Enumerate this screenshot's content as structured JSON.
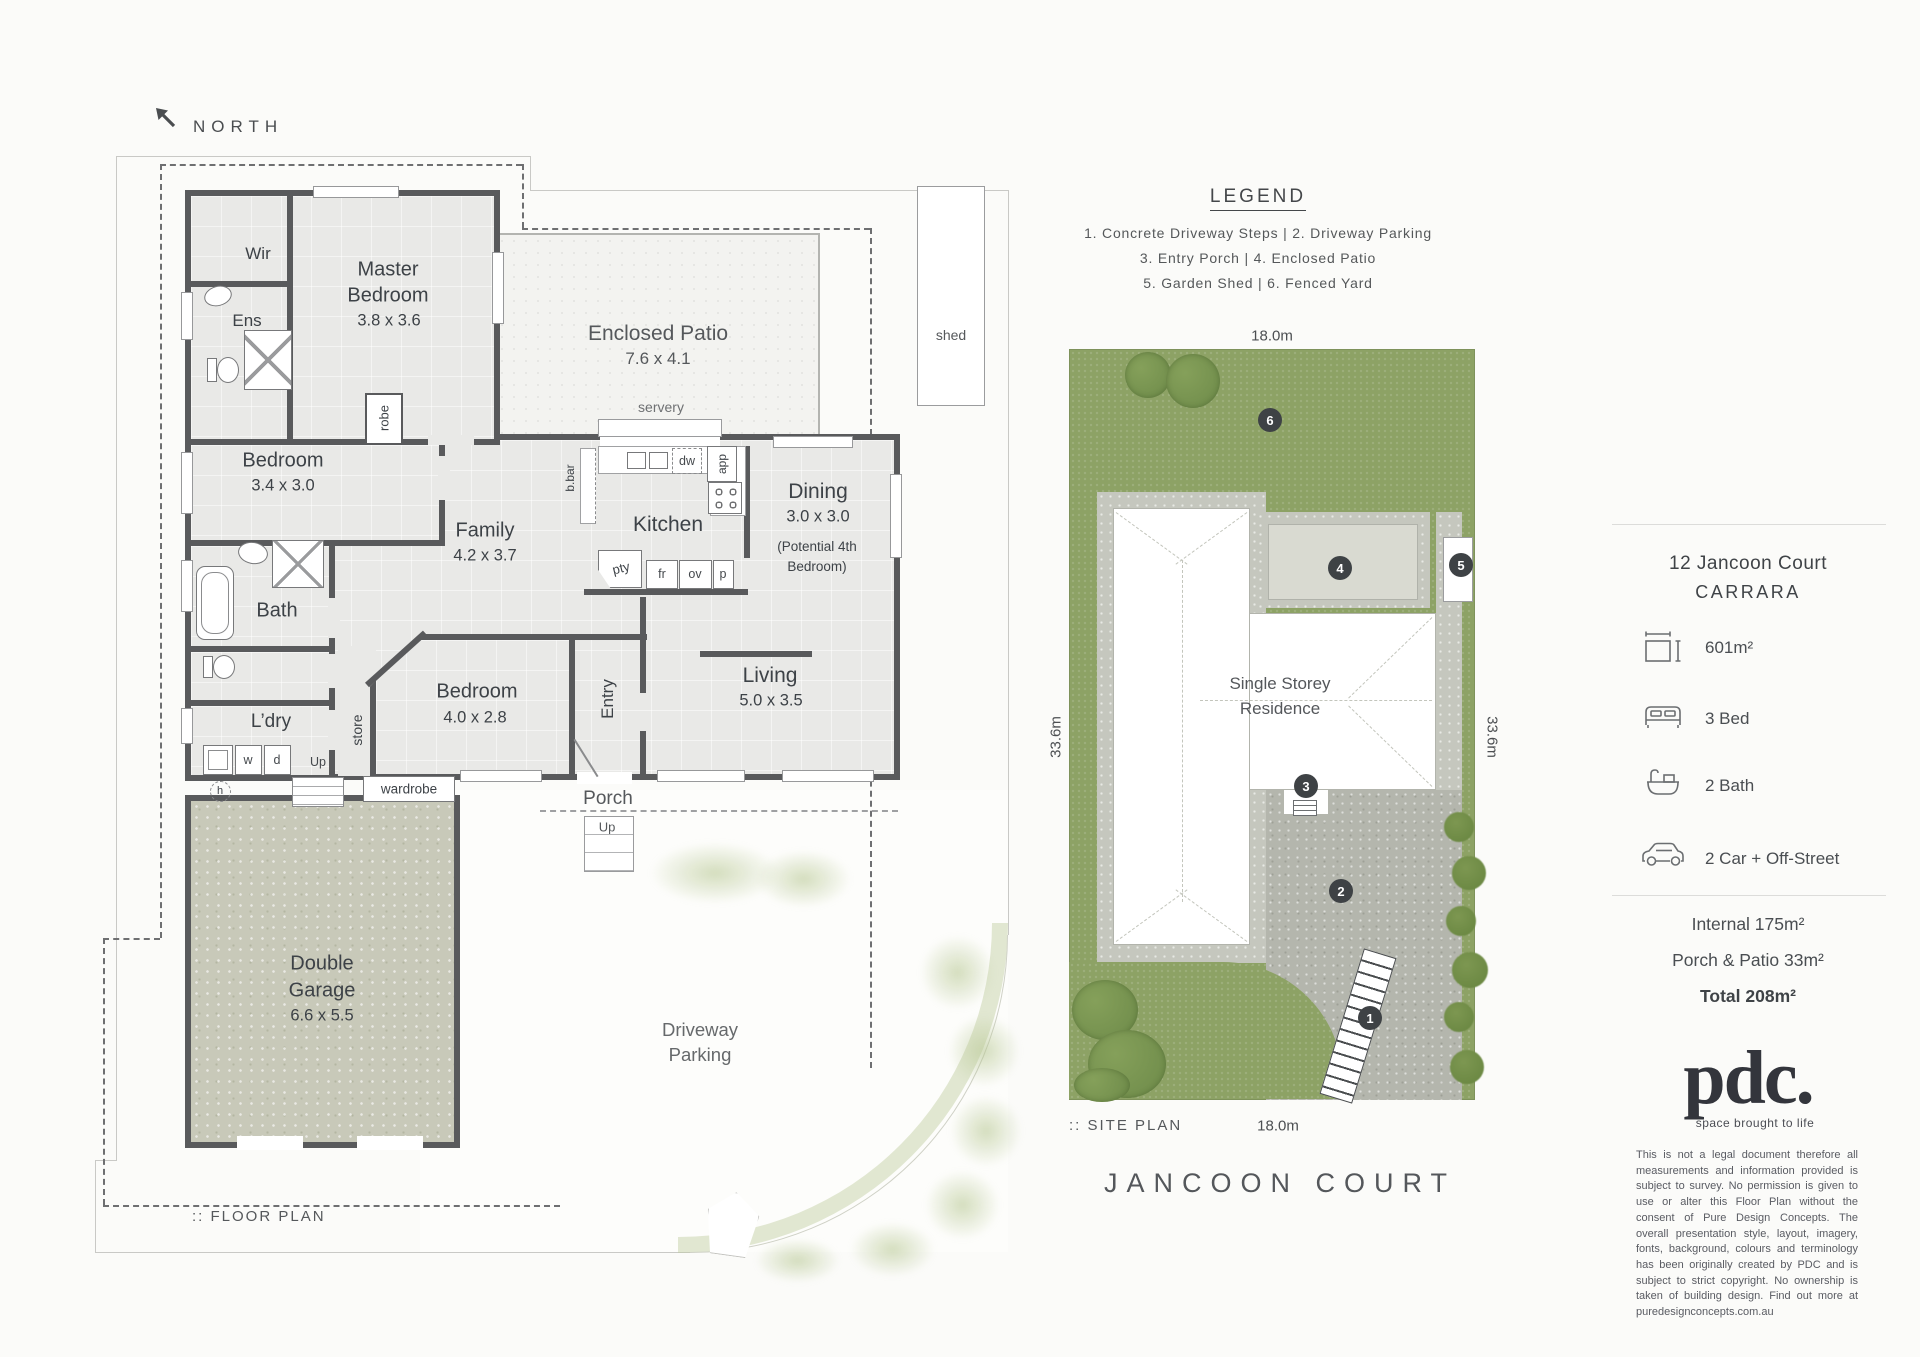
{
  "north": {
    "label": "NORTH"
  },
  "floor_plan": {
    "section_label": ":: FLOOR PLAN",
    "rooms": {
      "wir": "Wir",
      "ens": "Ens",
      "master_name1": "Master",
      "master_name2": "Bedroom",
      "master_dims": "3.8 x 3.6",
      "bedroom2_name": "Bedroom",
      "bedroom2_dims": "3.4 x 3.0",
      "bath": "Bath",
      "ldry": "L’dry",
      "bedroom3_name": "Bedroom",
      "bedroom3_dims": "4.0 x 2.8",
      "family_name": "Family",
      "family_dims": "4.2 x 3.7",
      "kitchen": "Kitchen",
      "dining_name": "Dining",
      "dining_dims": "3.0 x 3.0",
      "dining_note": "(Potential 4th Bedroom)",
      "living_name": "Living",
      "living_dims": "5.0 x 3.5",
      "entry": "Entry",
      "porch": "Porch",
      "garage_name1": "Double",
      "garage_name2": "Garage",
      "garage_dims": "6.6 x 5.5",
      "patio_name": "Enclosed Patio",
      "patio_dims": "7.6 x 4.1",
      "driveway": "Driveway Parking",
      "shed": "shed"
    },
    "fixtures": {
      "servery": "servery",
      "bbar": "b.bar",
      "dw": "dw",
      "app": "app",
      "pty": "pty",
      "fr": "fr",
      "ov": "ov",
      "p": "p",
      "w": "w",
      "d": "d",
      "h": "h",
      "up_hall": "Up",
      "up_porch": "Up",
      "store": "store",
      "robe": "robe",
      "wardrobe": "wardrobe"
    }
  },
  "legend": {
    "title": "LEGEND",
    "lines": [
      "1. Concrete Driveway Steps   |   2. Driveway Parking",
      "3. Entry Porch   |   4. Enclosed Patio",
      "5. Garden Shed   |   6. Fenced Yard"
    ]
  },
  "site_plan": {
    "section_label": ":: SITE PLAN",
    "width_top": "18.0m",
    "width_bottom": "18.0m",
    "depth_left": "33.6m",
    "depth_right": "33.6m",
    "residence_line1": "Single Storey",
    "residence_line2": "Residence",
    "street": "JANCOON COURT",
    "markers": [
      "1",
      "2",
      "3",
      "4",
      "5",
      "6"
    ]
  },
  "info_panel": {
    "address_line1": "12 Jancoon Court",
    "address_line2": "CARRARA",
    "land_area": "601m²",
    "beds": "3 Bed",
    "baths": "2 Bath",
    "cars": "2 Car + Off-Street",
    "internal": "Internal 175m²",
    "porch_patio": "Porch & Patio 33m²",
    "total": "Total 208m²"
  },
  "branding": {
    "logo": "pdc.",
    "tagline": "space brought to life",
    "disclaimer": "This is not a legal document therefore all measurements and information provided is subject to survey. No permission is given to use or alter this Floor Plan without the consent of Pure Design Concepts. The overall presentation style, layout, imagery, fonts, background, colours and terminology has been originally created by PDC and is subject to strict copyright. No ownership is taken of building design. Find out more at puredesignconcepts.com.au"
  }
}
